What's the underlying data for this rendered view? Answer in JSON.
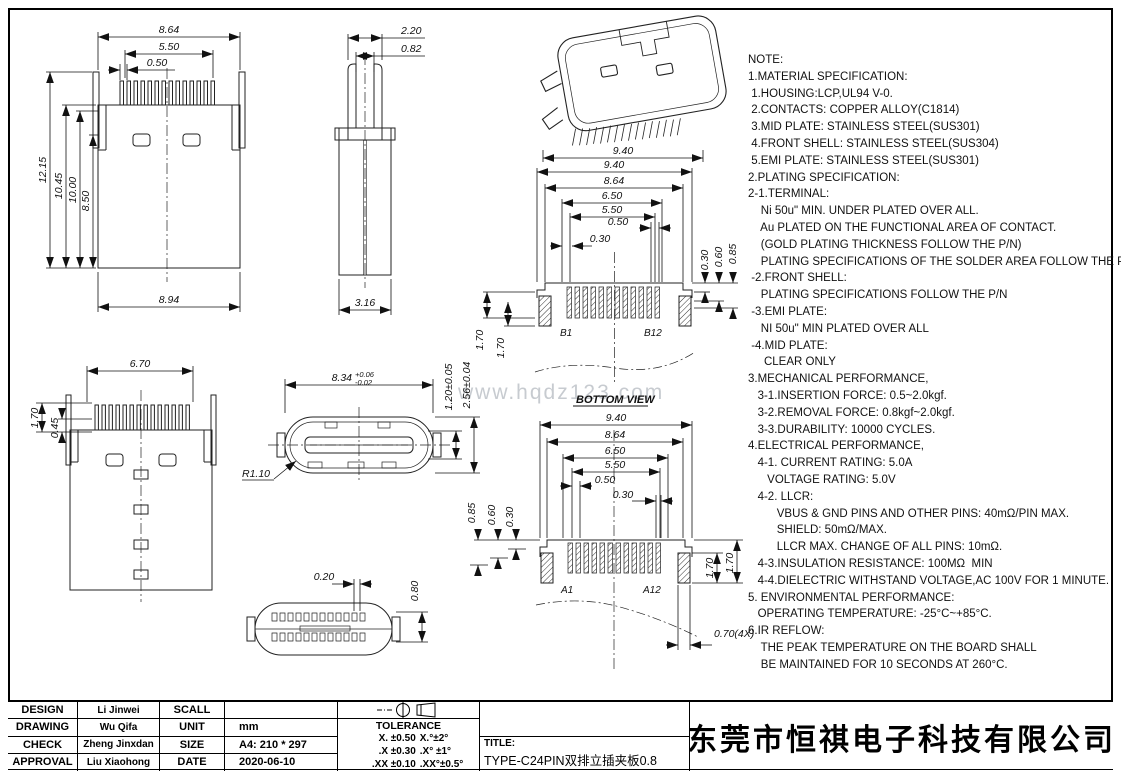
{
  "watermark": "www.hqdz123.com",
  "notes": {
    "lines": [
      "NOTE:",
      "1.MATERIAL SPECIFICATION:",
      " 1.HOUSING:LCP,UL94 V-0.",
      " 2.CONTACTS: COPPER ALLOY(C1814)",
      " 3.MID PLATE: STAINLESS STEEL(SUS301)",
      " 4.FRONT SHELL: STAINLESS STEEL(SUS304)",
      " 5.EMI PLATE: STAINLESS STEEL(SUS301)",
      "2.PLATING SPECIFICATION:",
      "2-1.TERMINAL:",
      "    Ni 50u\" MIN. UNDER PLATED OVER ALL.",
      "    Au PLATED ON THE FUNCTIONAL AREA OF CONTACT.",
      "    (GOLD PLATING THICKNESS FOLLOW THE P/N)",
      "    PLATING SPECIFICATIONS OF THE SOLDER AREA FOLLOW THE P/N",
      " -2.FRONT SHELL:",
      "    PLATING SPECIFICATIONS FOLLOW THE P/N",
      " -3.EMI PLATE:",
      "    NI 50u\" MIN PLATED OVER ALL",
      " -4.MID PLATE:",
      "     CLEAR ONLY",
      "3.MECHANICAL PERFORMANCE,",
      "   3-1.INSERTION FORCE: 0.5~2.0kgf.",
      "   3-2.REMOVAL FORCE: 0.8kgf~2.0kgf.",
      "   3-3.DURABILITY: 10000 CYCLES.",
      "4.ELECTRICAL PERFORMANCE,",
      "   4-1. CURRENT RATING: 5.0A",
      "      VOLTAGE RATING: 5.0V",
      "   4-2. LLCR:",
      "         VBUS & GND PINS AND OTHER PINS: 40mΩ/PIN MAX.",
      "         SHIELD: 50mΩ/MAX.",
      "         LLCR MAX. CHANGE OF ALL PINS: 10mΩ.",
      "   4-3.INSULATION RESISTANCE: 100MΩ  MIN",
      "   4-4.DIELECTRIC WITHSTAND VOLTAGE,AC 100V FOR 1 MINUTE.",
      "5. ENVIRONMENTAL PERFORMANCE:",
      "   OPERATING TEMPERATURE: -25°C~+85°C.",
      "6.IR REFLOW:",
      "    THE PEAK TEMPERATURE ON THE BOARD SHALL",
      "    BE MAINTAINED FOR 10 SECONDS AT 260°C."
    ]
  },
  "views": {
    "front": {
      "w_outer": "8.64",
      "w_mid": "5.50",
      "w_pitch": "0.50",
      "h1": "12.15",
      "h2": "10.45",
      "h3": "10.00",
      "h4": "8.50",
      "w_bottom": "8.94"
    },
    "side": {
      "w_clip": "2.20",
      "w_slot": "0.82",
      "w_body": "3.16"
    },
    "iso": {
      "w": "9.40"
    },
    "bottom": {
      "d1": "9.40",
      "d2": "8.64",
      "d3": "6.50",
      "d4": "5.50",
      "d5": "0.50",
      "d6": "0.30",
      "r1": "0.30",
      "r2": "0.60",
      "r3": "0.85",
      "l1": "1.70",
      "l2": "1.70",
      "pin_first": "B1",
      "pin_last": "B12",
      "caption": "BOTTOM VIEW"
    },
    "front2": {
      "w": "6.70",
      "h1": "1.70",
      "h2": "0.45"
    },
    "oval": {
      "w": "8.34",
      "tu": "+0.06",
      "td": "-0.02",
      "r": "R1.10",
      "h1": "1.20±0.05",
      "h2": "2.56±0.04"
    },
    "boval": {
      "d1": "0.20",
      "d2": "0.80"
    },
    "top": {
      "d1": "9.40",
      "d2": "8.64",
      "d3": "6.50",
      "d4": "5.50",
      "d5": "0.50",
      "d6": "0.30",
      "l1": "0.85",
      "l2": "0.60",
      "l3": "0.30",
      "r1": "1.70",
      "r2": "1.70",
      "b1": "0.70(4X)",
      "pin_first": "A1",
      "pin_last": "A12"
    }
  },
  "title_block": {
    "rows": [
      {
        "label": "DESIGN",
        "name": "Li Jinwei",
        "key": "SCALL",
        "value": ""
      },
      {
        "label": "DRAWING",
        "name": "Wu Qifa",
        "key": "UNIT",
        "value": "mm"
      },
      {
        "label": "CHECK",
        "name": "Zheng Jinxdan",
        "key": "SIZE",
        "value": "A4: 210 * 297"
      },
      {
        "label": "APPROVAL",
        "name": "Liu Xiaohong",
        "key": "DATE",
        "value": "2020-06-10"
      }
    ],
    "tolerance": {
      "header": "TOLERANCE",
      "rows": [
        {
          "l": "X.  ±0.50",
          "r": "X.°±2°"
        },
        {
          "l": ".X  ±0.30",
          "r": ".X° ±1°"
        },
        {
          "l": ".XX ±0.10",
          "r": ".XX°±0.5°"
        }
      ]
    },
    "title_label": "TITLE:",
    "title_value": "TYPE-C24PIN双排立插夹板0.8",
    "company": "东莞市恒祺电子科技有限公司"
  }
}
